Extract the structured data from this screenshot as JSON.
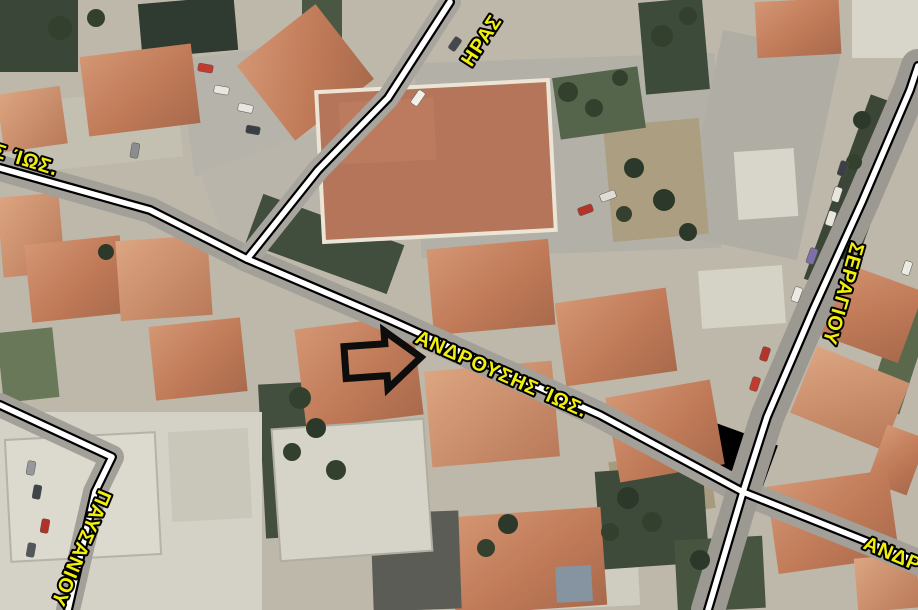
{
  "map": {
    "type": "aerial-satellite-map",
    "labels": {
      "hras": "ΗΡΑΣ",
      "left_fragment": "Σ ΊΩΣ.",
      "main": "ΑΝΔΡΟΥΣΗΣ ΊΩΣ.",
      "seragiou": "ΣΕΡΑΓΙΟΥ",
      "pafsaniou": "ΠΑΥΣΑΝΙΟΥ",
      "bottom_right_fragment": "ΑΝΔΡ"
    },
    "marker": {
      "shape": "block-arrow-pointing-right",
      "target": "ΑΝΔΡΟΥΣΗΣ ΊΩΣ."
    },
    "colors": {
      "label_fill": "#f2ef0c",
      "label_outline": "#000000",
      "road_line_core": "#ffffff",
      "road_line_edge": "#000000",
      "marker": "#0d0d0d",
      "roof": "#c07d5c",
      "road_surface": "#a3a099",
      "vegetation": "#41503c"
    }
  }
}
